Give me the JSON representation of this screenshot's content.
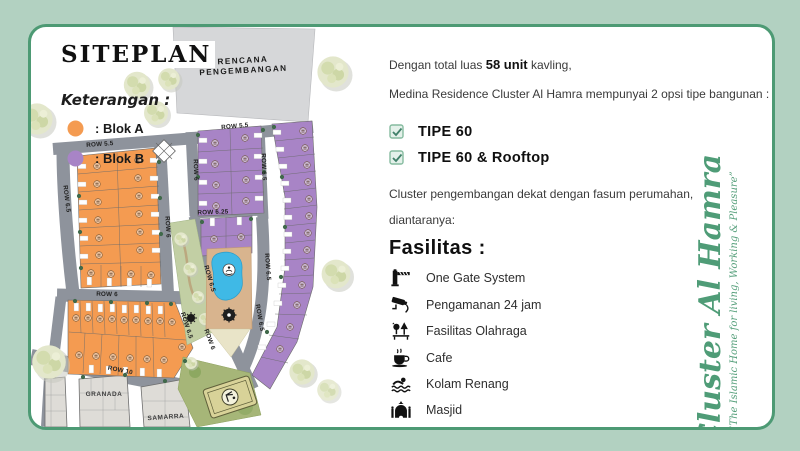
{
  "title": "SITEPLAN",
  "legend": {
    "heading": "Keterangan :",
    "items": [
      {
        "label": ": Blok A",
        "color": "#F49B51"
      },
      {
        "label": ": Blok B",
        "color": "#A884C6"
      }
    ]
  },
  "map": {
    "development_area": {
      "line1": "RENCANA",
      "line2": "PENGEMBANGAN"
    },
    "rows": [
      "ROW 5.5",
      "ROW 5.5",
      "ROW 6.5",
      "ROW 6",
      "ROW 6",
      "ROW 6",
      "ROW 6.5",
      "ROW 6.25",
      "ROW 6.5",
      "ROW 6.5",
      "ROW 6.5",
      "ROW 10",
      "ROW 6",
      "ROW 6.5"
    ],
    "neighbors": [
      "GRANADA",
      "SAMARRA"
    ]
  },
  "info": {
    "line1": {
      "prefix": "Dengan total luas ",
      "bold": "58 unit",
      "suffix": " kavling,"
    },
    "line2": "Medina Residence Cluster Al Hamra mempunyai 2 opsi tipe bangunan :",
    "options": [
      "TIPE 60",
      "TIPE 60 & Rooftop"
    ],
    "para": [
      "Cluster pengembangan dekat dengan fasum perumahan,",
      "diantaranya:"
    ],
    "facilities_heading": "Fasilitas :",
    "facilities": [
      {
        "icon": "gate-icon",
        "label": "One Gate System"
      },
      {
        "icon": "cctv-icon",
        "label": "Pengamanan 24 jam"
      },
      {
        "icon": "sport-icon",
        "label": "Fasilitas Olahraga"
      },
      {
        "icon": "cafe-icon",
        "label": "Cafe"
      },
      {
        "icon": "swim-icon",
        "label": "Kolam Renang"
      },
      {
        "icon": "mosque-icon",
        "label": "Masjid"
      }
    ]
  },
  "branding": {
    "name": "Cluster Al Hamra",
    "tagline": "“The Islamic Home for living, Working & Pleasure”"
  },
  "colors": {
    "frame_bg": "#B2D1C1",
    "frame_border": "#4D9A74",
    "blok_a": "#F49B51",
    "blok_b": "#A884C6",
    "road": "#8E939C",
    "script_green": "#4F9C77"
  }
}
